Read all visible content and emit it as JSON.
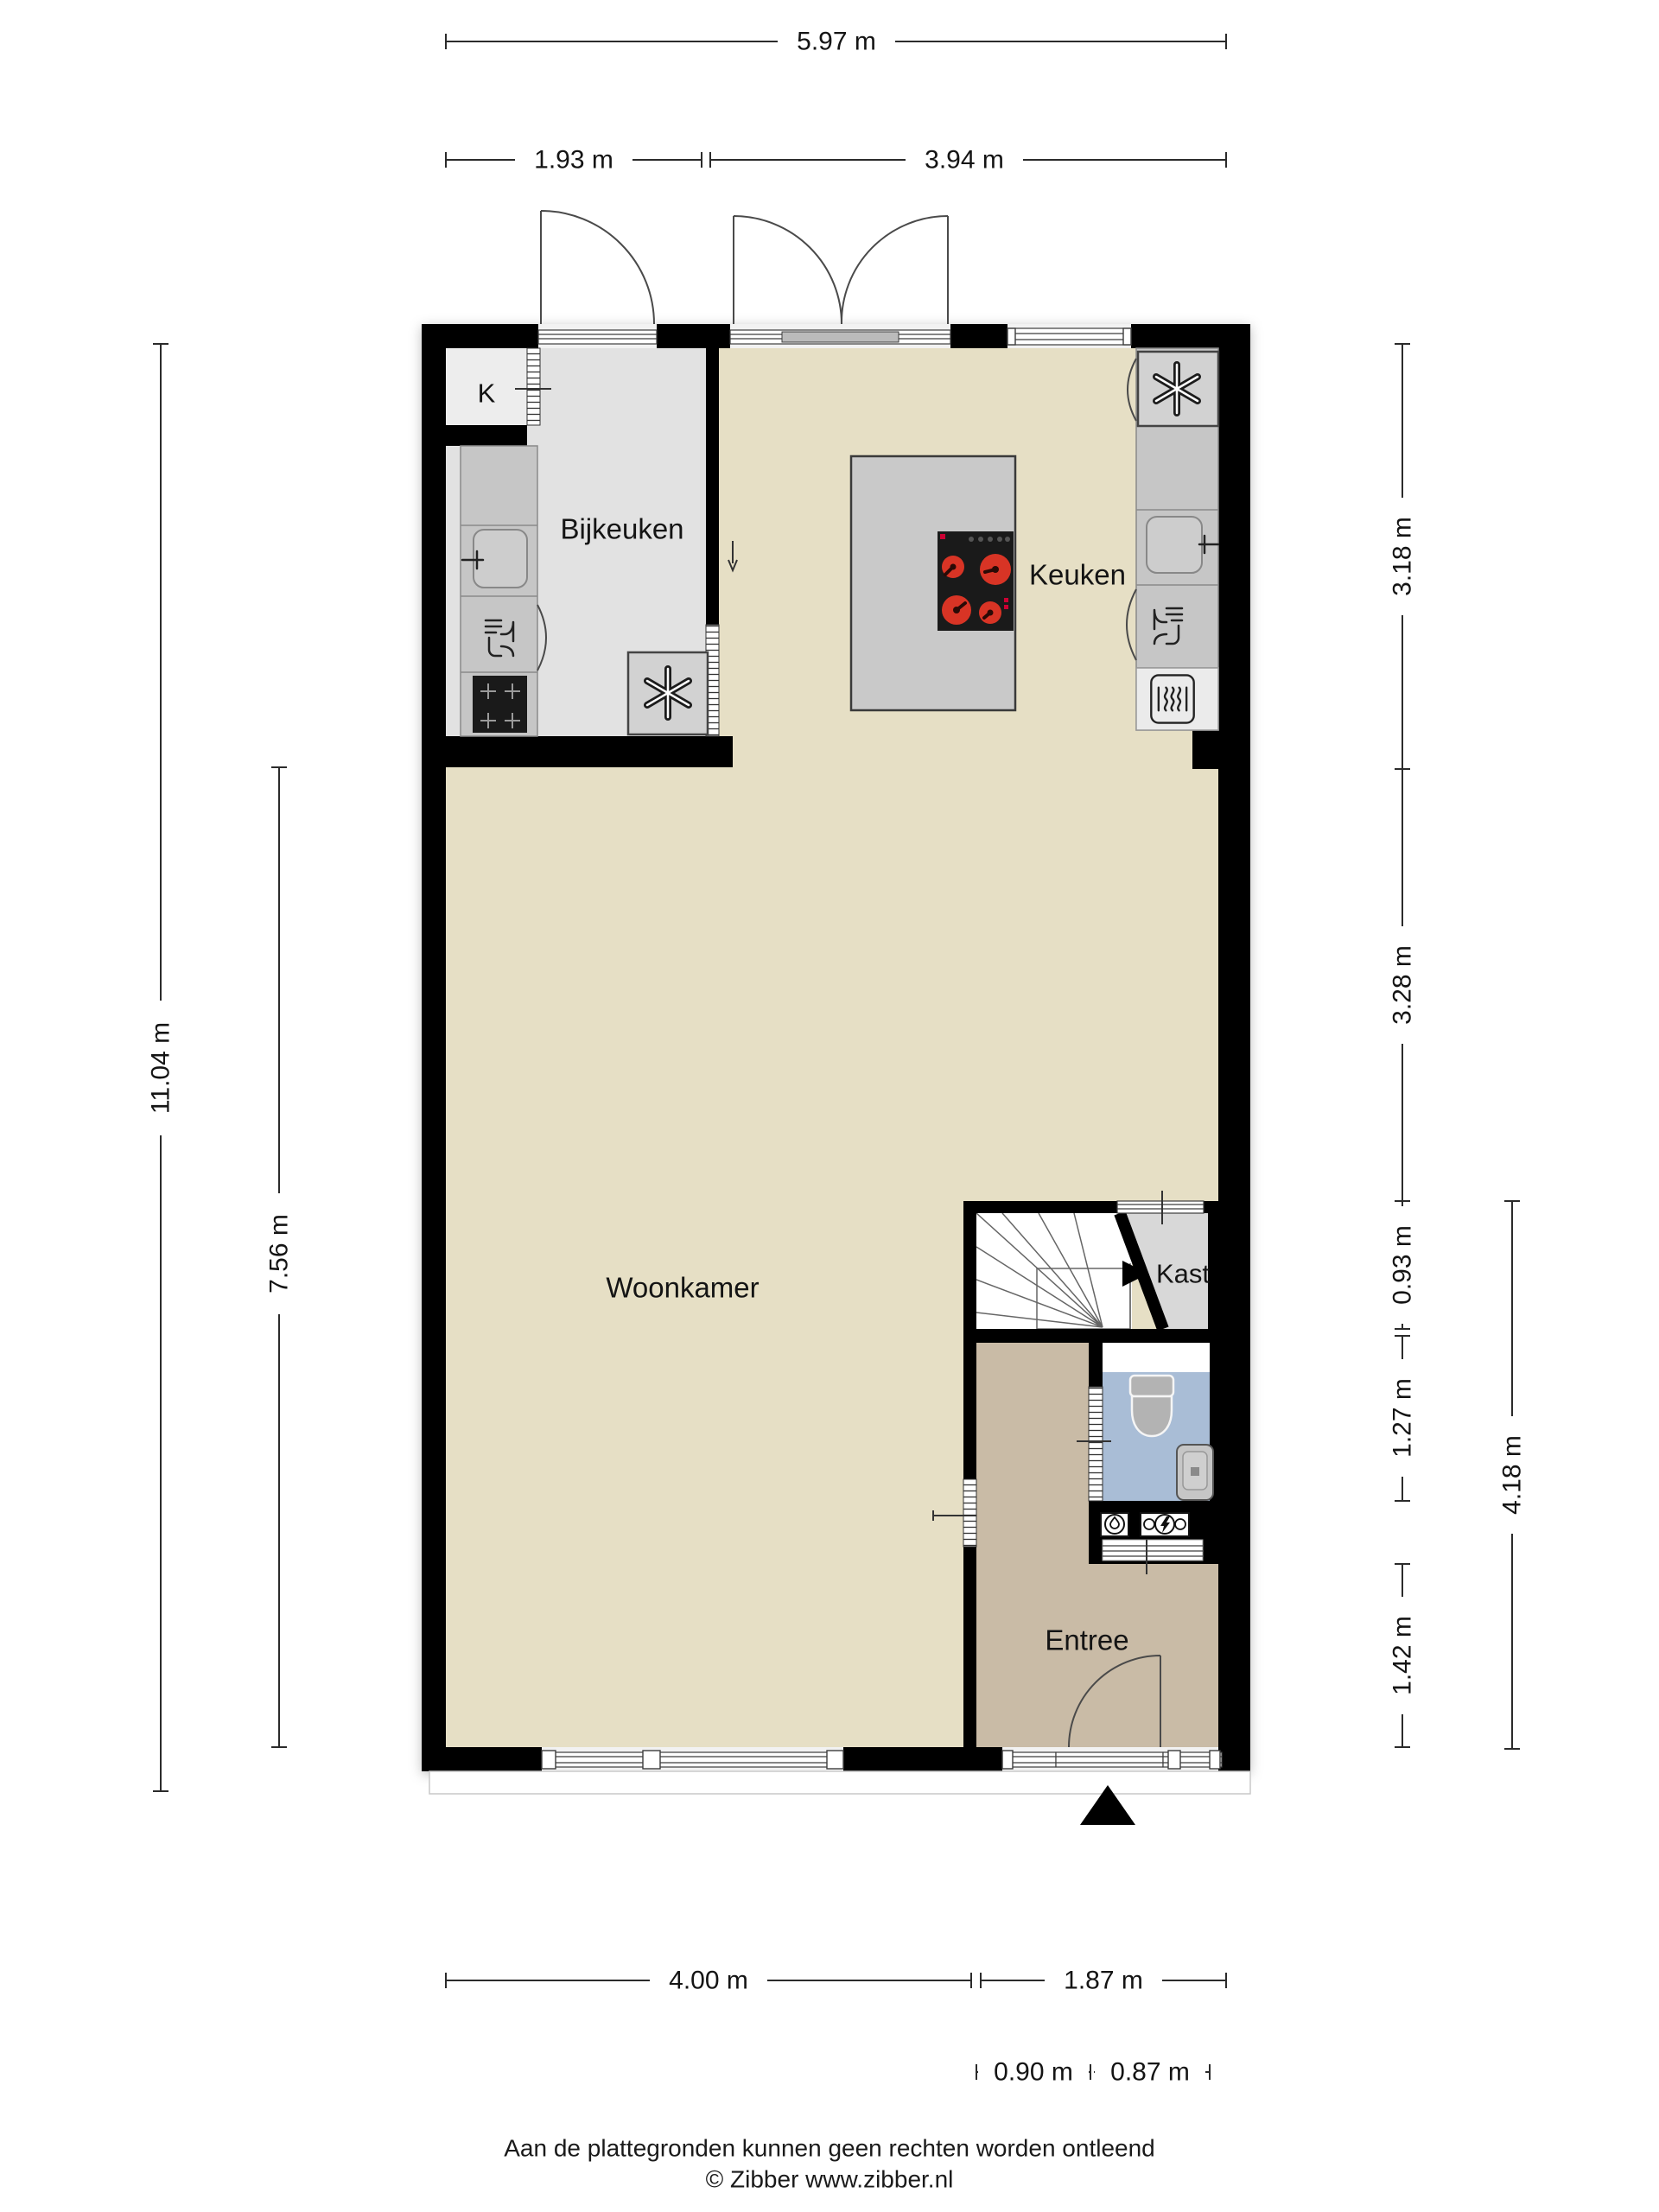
{
  "rooms": {
    "k": "K",
    "bijkeuken": "Bijkeuken",
    "keuken": "Keuken",
    "woonkamer": "Woonkamer",
    "kast": "Kast",
    "entree": "Entree"
  },
  "dims": {
    "top_total": "5.97 m",
    "top_left": "1.93 m",
    "top_right": "3.94 m",
    "left_outer": "11.04 m",
    "left_inner": "7.56 m",
    "right_kitchen": "3.18 m",
    "right_living": "3.28 m",
    "right_kast": "0.93 m",
    "right_toilet": "1.27 m",
    "right_entree": "1.42 m",
    "right_outer": "4.18 m",
    "bottom_living": "4.00 m",
    "bottom_entree": "1.87 m",
    "bottom_hall": "0.90 m",
    "bottom_toilet": "0.87 m"
  },
  "footer": {
    "line1": "Aan de plattegronden kunnen geen rechten worden ontleend",
    "line2": "© Zibber www.zibber.nl"
  },
  "colors": {
    "wall": "#000000",
    "floor_main": "#e6dfc5",
    "floor_bijkeuken": "#e2e2e2",
    "floor_k": "#ededed",
    "floor_kast": "#d8d8d8",
    "floor_stairs": "#ffffff",
    "floor_toilet": "#a9bdd6",
    "floor_toilet_hall": "#ffffff",
    "floor_entree": "#c9bba6",
    "counter": "#c6c6c6",
    "appliance": "#d2d2d2",
    "oven_block": "#ebebeb",
    "island": "#c9c9c9",
    "cooktop": "#1a1a1a",
    "burner": "#d83425",
    "fixture": "#b3b3b3"
  }
}
